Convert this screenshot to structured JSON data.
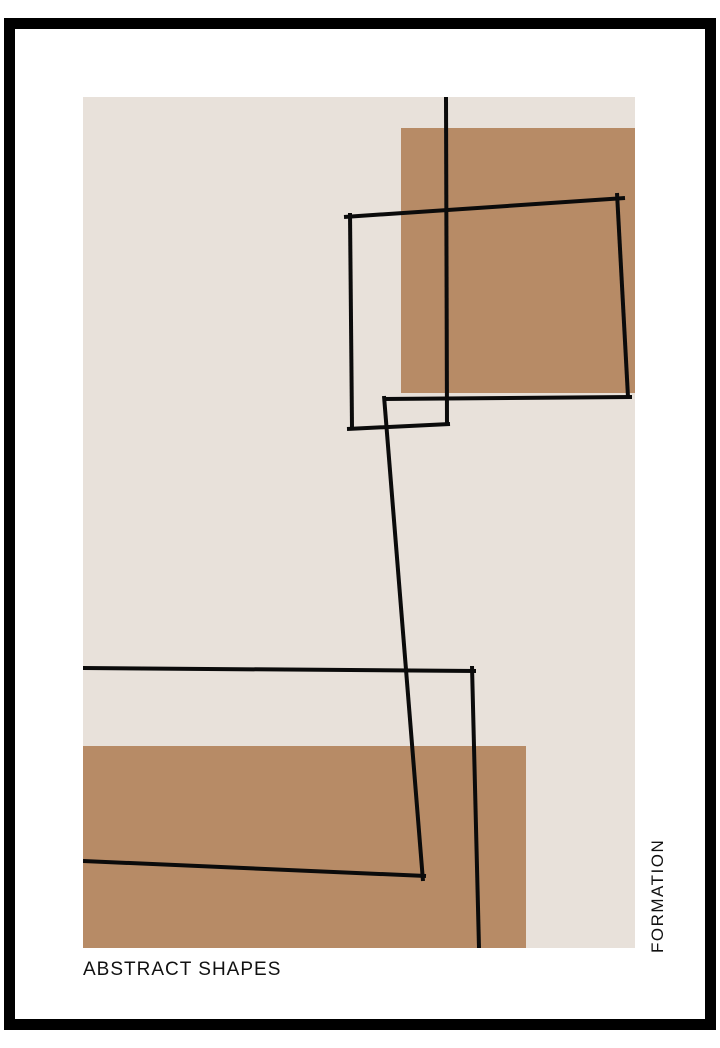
{
  "poster": {
    "title": "ABSTRACT SHAPES",
    "side_label": "FORMATION"
  },
  "colors": {
    "page_bg": "#ffffff",
    "frame": "#000000",
    "mat": "#ffffff",
    "panel": "#e8e1da",
    "accent": "#b78b66",
    "line": "#0b0b0b",
    "text": "#111111"
  },
  "artwork": {
    "canvas": {
      "w": 720,
      "h": 1048
    },
    "panel": {
      "x": 83,
      "y": 97,
      "w": 552,
      "h": 851
    },
    "accent_rects": [
      {
        "name": "accent-rect-top-right",
        "x": 401,
        "y": 128,
        "w": 234,
        "h": 265
      },
      {
        "name": "accent-rect-bottom-left",
        "x": 83,
        "y": 746,
        "w": 443,
        "h": 202
      }
    ],
    "stroke_width": 4,
    "lines": [
      {
        "name": "long-vertical-line",
        "x1": 446,
        "y1": 97,
        "x2": 447,
        "y2": 425
      },
      {
        "name": "big-quad-top-edge",
        "x1": 344,
        "y1": 217,
        "x2": 625,
        "y2": 198
      },
      {
        "name": "big-quad-right-edge",
        "x1": 617,
        "y1": 193,
        "x2": 628,
        "y2": 397
      },
      {
        "name": "big-quad-bottom-edge",
        "x1": 383,
        "y1": 399,
        "x2": 632,
        "y2": 397
      },
      {
        "name": "small-quad-left-edge",
        "x1": 350,
        "y1": 213,
        "x2": 352,
        "y2": 428
      },
      {
        "name": "small-quad-bottom-edge",
        "x1": 347,
        "y1": 429,
        "x2": 450,
        "y2": 424
      },
      {
        "name": "long-diagonal-line",
        "x1": 384,
        "y1": 396,
        "x2": 423,
        "y2": 881
      },
      {
        "name": "lower-quad-top-edge",
        "x1": 83,
        "y1": 668,
        "x2": 476,
        "y2": 671
      },
      {
        "name": "lower-quad-right-edge",
        "x1": 472,
        "y1": 666,
        "x2": 479,
        "y2": 948
      },
      {
        "name": "lower-quad-bottom-edge",
        "x1": 83,
        "y1": 861,
        "x2": 426,
        "y2": 876
      }
    ]
  }
}
